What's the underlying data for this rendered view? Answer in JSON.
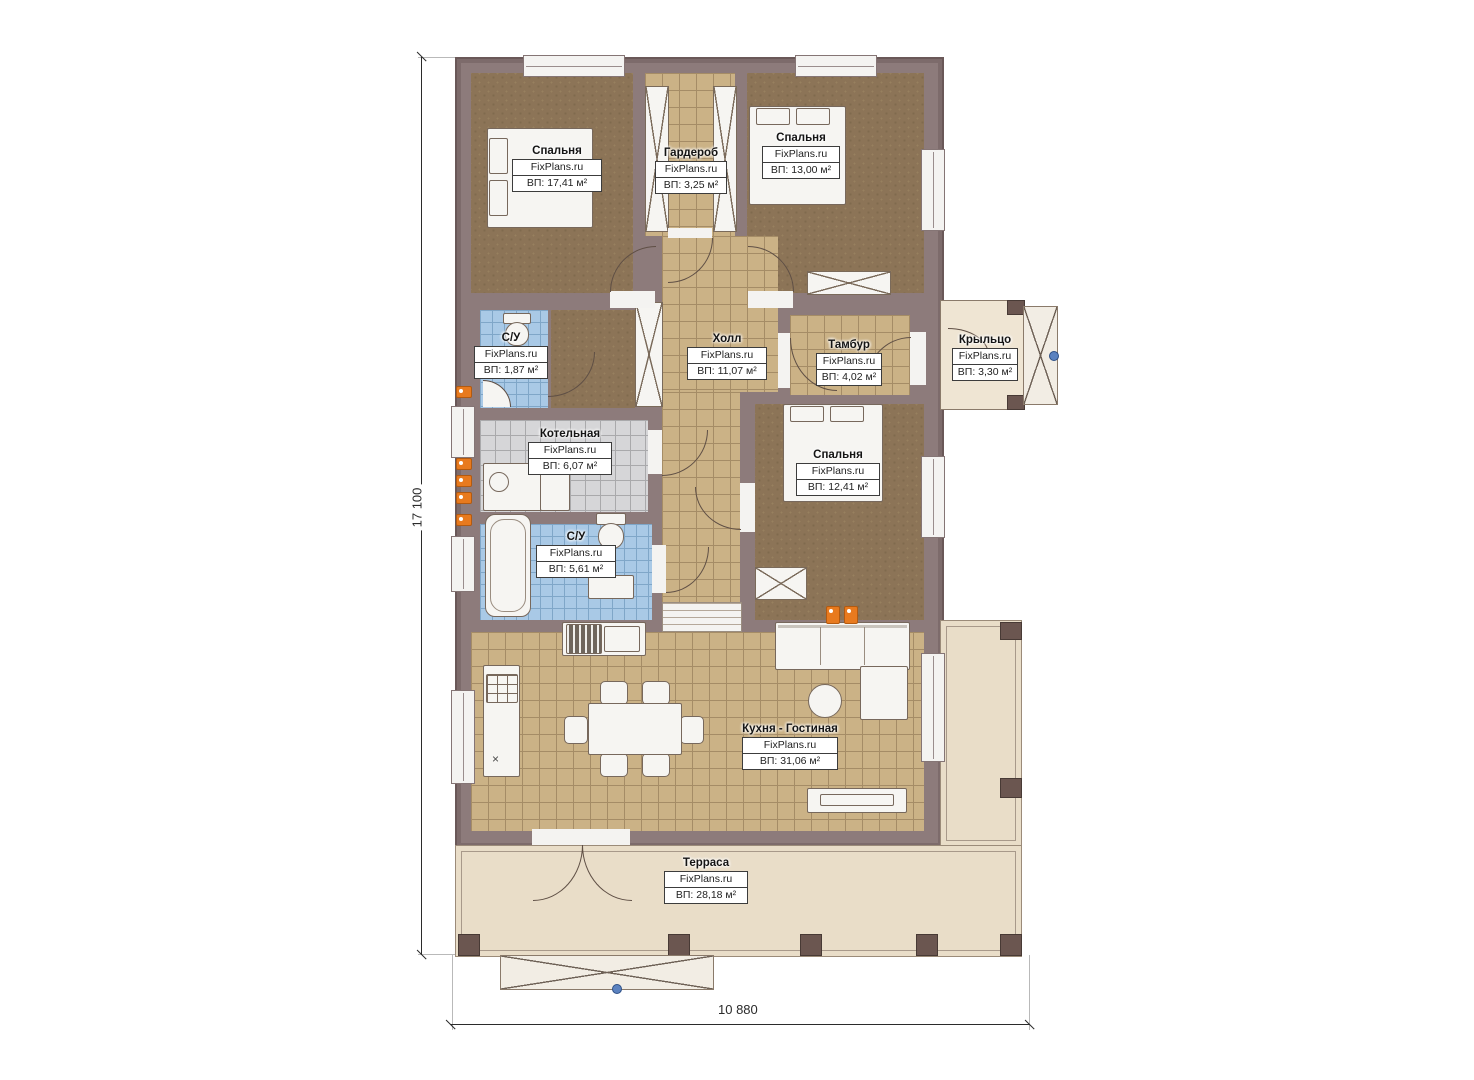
{
  "plan_title": "floor-plan",
  "watermark": "FixPlans.ru",
  "rooms": [
    {
      "id": "bedroom-1",
      "name": "Спальня",
      "watermark": "FixPlans.ru",
      "area": "ВП: 17,41 м²"
    },
    {
      "id": "wardrobe",
      "name": "Гардероб",
      "watermark": "FixPlans.ru",
      "area": "ВП: 3,25 м²"
    },
    {
      "id": "bedroom-2",
      "name": "Спальня",
      "watermark": "FixPlans.ru",
      "area": "ВП: 13,00 м²"
    },
    {
      "id": "bathroom-1",
      "name": "С/У",
      "watermark": "FixPlans.ru",
      "area": "ВП: 1,87 м²"
    },
    {
      "id": "hall",
      "name": "Холл",
      "watermark": "FixPlans.ru",
      "area": "ВП: 11,07 м²"
    },
    {
      "id": "tambour",
      "name": "Тамбур",
      "watermark": "FixPlans.ru",
      "area": "ВП: 4,02 м²"
    },
    {
      "id": "porch",
      "name": "Крыльцо",
      "watermark": "FixPlans.ru",
      "area": "ВП: 3,30 м²"
    },
    {
      "id": "boiler-room",
      "name": "Котельная",
      "watermark": "FixPlans.ru",
      "area": "ВП: 6,07 м²"
    },
    {
      "id": "bedroom-3",
      "name": "Спальня",
      "watermark": "FixPlans.ru",
      "area": "ВП: 12,41 м²"
    },
    {
      "id": "bathroom-2",
      "name": "С/У",
      "watermark": "FixPlans.ru",
      "area": "ВП: 5,61 м²"
    },
    {
      "id": "kitchen-living",
      "name": "Кухня - Гостиная",
      "watermark": "FixPlans.ru",
      "area": "ВП: 31,06 м²"
    },
    {
      "id": "terrace",
      "name": "Терраса",
      "watermark": "FixPlans.ru",
      "area": "ВП: 28,18 м²"
    }
  ],
  "dimensions": {
    "vertical": "17 100",
    "horizontal": "10 880"
  },
  "markers": {
    "kitchen_cross": "×"
  },
  "palette": {
    "wall": "#8d7b7b",
    "wall_edge": "#6a5858",
    "carpet": "#8c7457",
    "tile_tan": "#cbb286",
    "tile_blue": "#a9c9e6",
    "tile_gray": "#d6d6d8",
    "terrace": "#e9ddc8",
    "porch": "#efe5d3",
    "radiator": "#e87a1e",
    "entry_dot": "#5b82c0"
  }
}
